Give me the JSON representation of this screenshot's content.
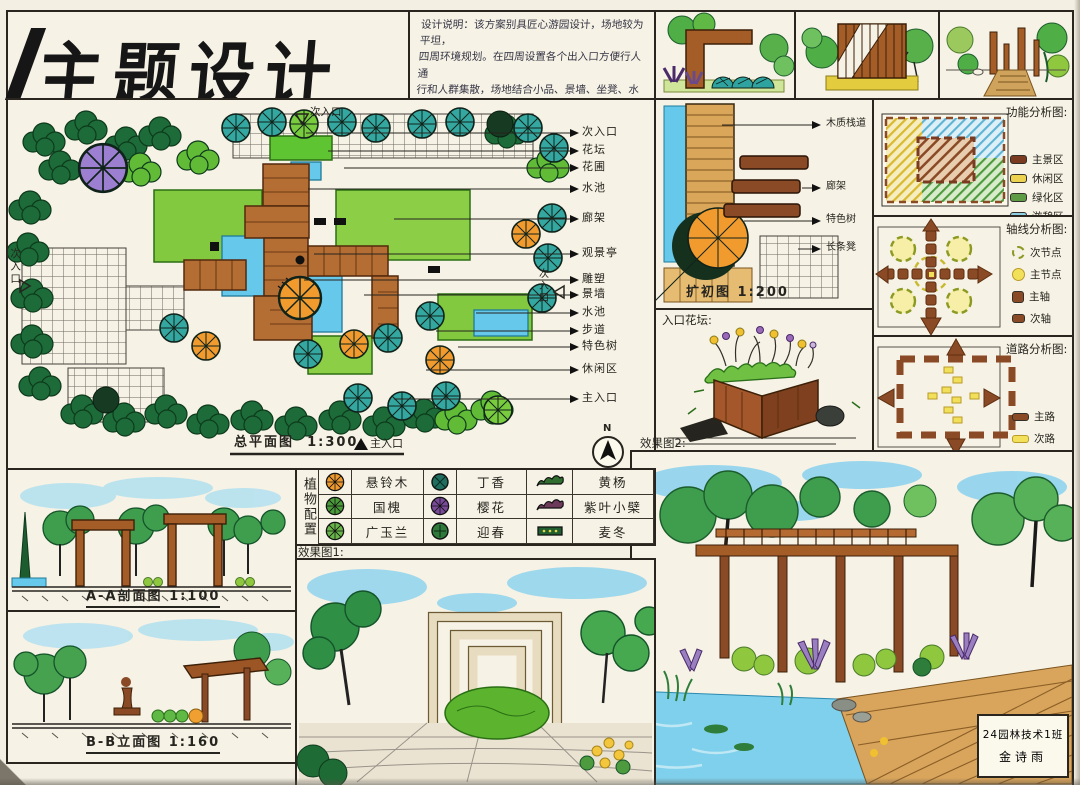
{
  "palette": {
    "paper": "#f3efe2",
    "ink": "#26241f",
    "wood_brown": "#8a4a26",
    "deck_tan": "#d9a45b",
    "lawn_green": "#83c93f",
    "dark_leaf": "#1c6b38",
    "teal_tree": "#35a7a1",
    "water_blue": "#66c9ec",
    "sky_blue": "#8fd4ee",
    "orange_tree": "#f19a2e",
    "purple_tree": "#9d7fd2",
    "accent_yellow": "#f2e05a"
  },
  "title": {
    "text": "主题设计"
  },
  "notes": {
    "lines": [
      "设计说明：该方案别具匠心游园设计，场地较为平坦，",
      "四周环境规划。在四周设置各个出入口方便行人通",
      "行和人群集散，场地结合小品、景墙、坐凳、水池、廊",
      "架打造优美环境，在植物配置上做到乔灌草结合",
      "搭配设置，做到三季有花，以规则式总体布置。"
    ]
  },
  "master_plan": {
    "caption": "总平面图",
    "scale": "1:300",
    "north": "N",
    "entrance_top": "次入口",
    "entrance_left": "次入口",
    "entrance_right": "次入口",
    "entrance_main": "主入口",
    "callouts": [
      "次入口",
      "花坛",
      "花圃",
      "水池",
      "廊架",
      "观景亭",
      "雕塑",
      "景墙",
      "水池",
      "步道",
      "特色树",
      "休闲区",
      "主入口"
    ]
  },
  "detail_plan": {
    "caption": "扩初图",
    "scale": "1:200",
    "callouts": [
      "木质栈道",
      "廊架",
      "特色树",
      "长条凳"
    ]
  },
  "entry_bed": {
    "label": "入口花坛:"
  },
  "diagrams": {
    "function": {
      "title": "功能分析图:",
      "legend": [
        {
          "label": "主景区",
          "color": "#7a3b20"
        },
        {
          "label": "休闲区",
          "color": "#ecd24e"
        },
        {
          "label": "绿化区",
          "color": "#5d9c44"
        },
        {
          "label": "游憩区",
          "color": "#8fd0e6"
        }
      ]
    },
    "axis": {
      "title": "轴线分析图:",
      "legend": [
        {
          "label": "次节点"
        },
        {
          "label": "主节点"
        },
        {
          "label": "主轴"
        },
        {
          "label": "次轴"
        }
      ]
    },
    "road": {
      "title": "道路分析图:",
      "legend": [
        {
          "label": "主路",
          "color": "#8a4a26"
        },
        {
          "label": "次路",
          "color": "#f2e05a"
        }
      ]
    }
  },
  "plants": {
    "header": "植物配置",
    "rows": [
      [
        {
          "name": "悬铃木",
          "color": "#ef9a2e"
        },
        {
          "name": "丁香",
          "color": "#1f6e5e"
        },
        {
          "name": "黄杨",
          "color": "#2f6e2f"
        }
      ],
      [
        {
          "name": "国槐",
          "color": "#4a9b3a"
        },
        {
          "name": "樱花",
          "color": "#7a4a9a"
        },
        {
          "name": "紫叶小檗",
          "color": "#6e3a5a"
        }
      ],
      [
        {
          "name": "广玉兰",
          "color": "#6ab54a"
        },
        {
          "name": "迎春",
          "color": "#2f7a3a"
        },
        {
          "name": "麦冬",
          "color": "#1f5e2f"
        }
      ]
    ]
  },
  "sections": {
    "aa": {
      "caption": "A-A剖面图",
      "scale": "1:100"
    },
    "bb": {
      "caption": "B-B立面图",
      "scale": "1:160"
    }
  },
  "renders": {
    "r1_label": "效果图1:",
    "r2_label": "效果图2:"
  },
  "signature": {
    "line1": "24园林技术1班",
    "line2": "金诗雨"
  }
}
